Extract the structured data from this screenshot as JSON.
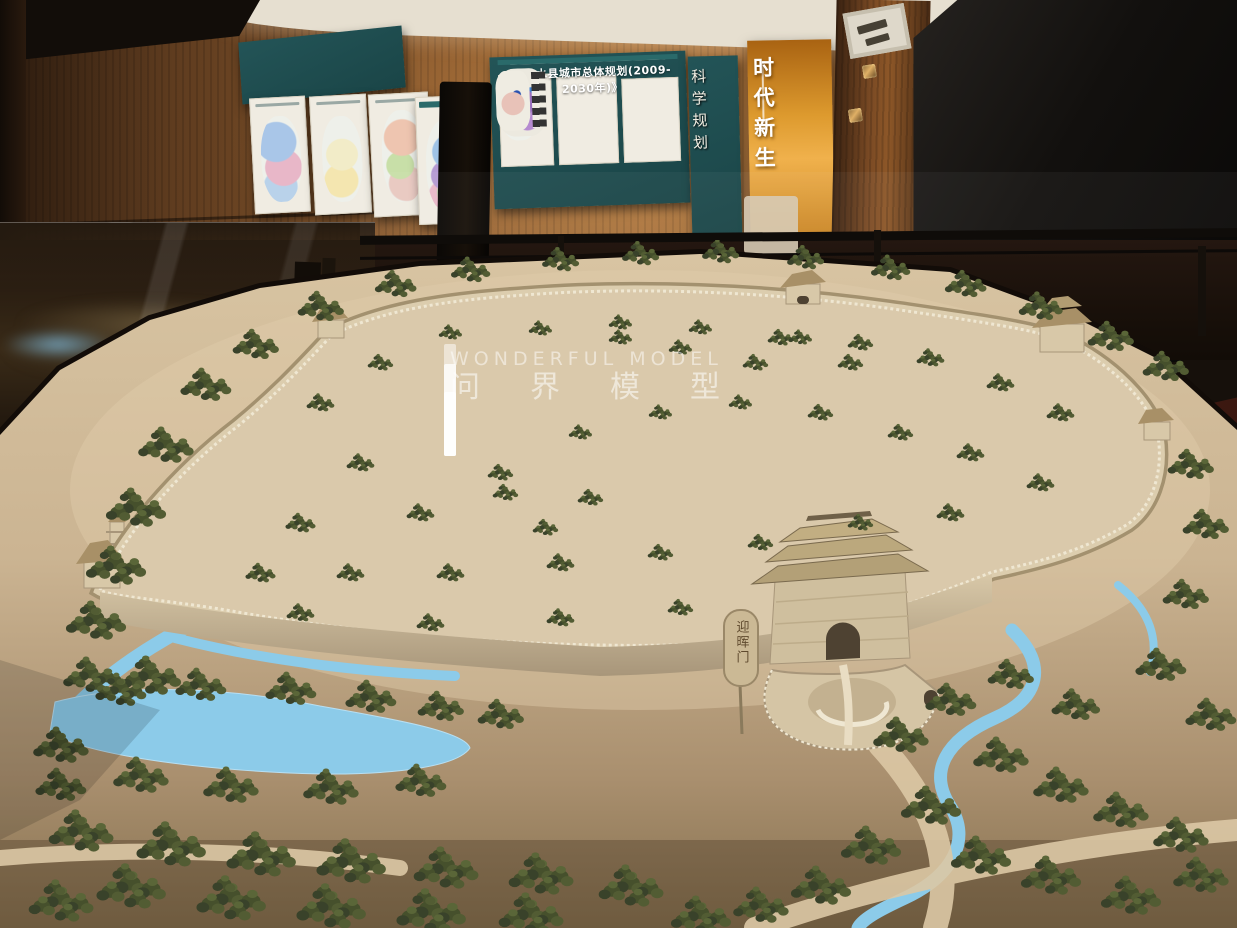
{
  "scene": {
    "type": "photograph",
    "subject": "Museum exhibition hall with a large scale model of an ancient walled city"
  },
  "panels": {
    "master_plan_title": "《涟水县城市总体规划(2009-2030年)》",
    "science_slogan": "科学规划",
    "era_slogan": "时代新生"
  },
  "model": {
    "gate_plaque": "迎晖门"
  },
  "watermark": {
    "cn": "问界模型",
    "en": "WONDERFUL MODEL"
  },
  "colors": {
    "teal_panel": "#1b4a4c",
    "gold_panel": "#d8912a",
    "wood_wall": "#8a5a2e",
    "sand": "#cbb492",
    "water": "#85c6e8",
    "trees": "#46502c",
    "screen": "#0d0b0a"
  }
}
